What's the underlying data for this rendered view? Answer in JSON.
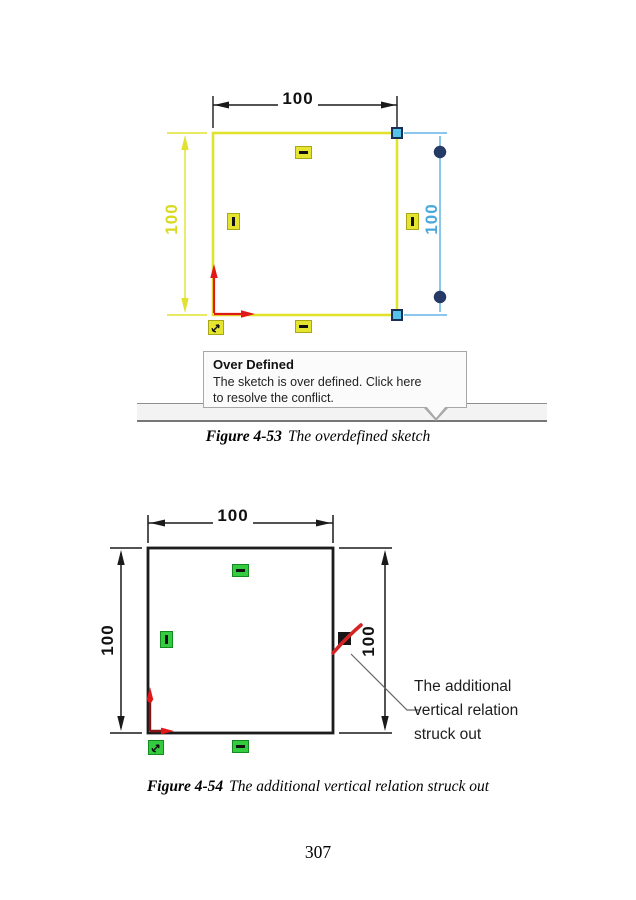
{
  "page_number": "307",
  "colors": {
    "sketch_yellow": "#e2e22e",
    "dimension_blue": "#62b5e5",
    "handle_blue": "#55c2ec",
    "handle_navy": "#1d2e55",
    "relation_green": "#35cb41",
    "relation_yellow": "#e4e431",
    "origin_red": "#e01818",
    "origin_dark_red": "#8b1515",
    "struck_red": "#d42424",
    "sketch_black": "#1c1c1c"
  },
  "icons": {
    "horizontal_relation": "horizontal-bar",
    "vertical_relation": "vertical-bar",
    "fixed_relation": "anchor-glyph",
    "struck_vertical_relation": "dark-square-with-red-slash",
    "origin": "red-L-arrows",
    "endpoint_handle": "blue-square",
    "dimension_grip": "navy-circle"
  },
  "figure1": {
    "caption": {
      "label": "Figure 4-53",
      "text": "The overdefined sketch"
    },
    "dimensions": {
      "top": "100",
      "left": "100",
      "right": "100"
    },
    "tooltip": {
      "title": "Over Defined",
      "body": [
        "The sketch is over defined. Click here",
        "to resolve the conflict."
      ]
    }
  },
  "figure2": {
    "caption": {
      "label": "Figure 4-54",
      "text": "The additional vertical relation struck out"
    },
    "dimensions": {
      "top": "100",
      "left": "100",
      "right": "100"
    },
    "annotation": [
      "The additional",
      "vertical relation",
      "struck out"
    ]
  }
}
